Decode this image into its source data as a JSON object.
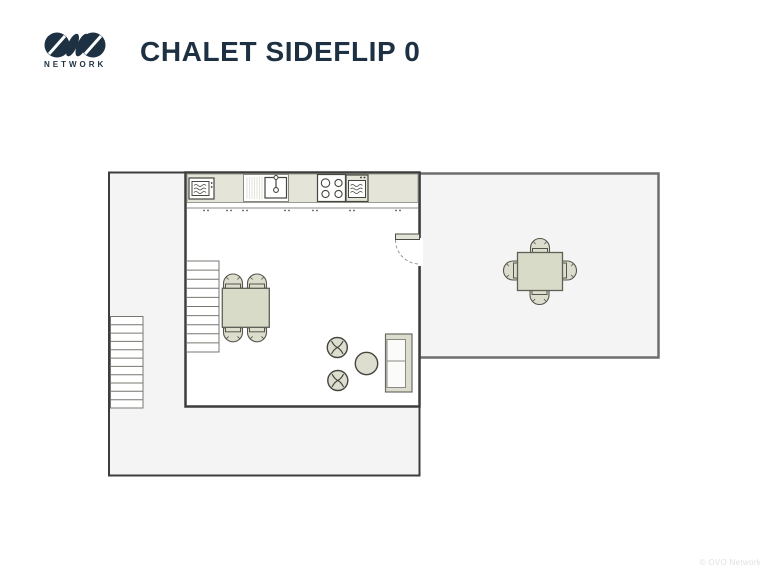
{
  "header": {
    "logo": {
      "brand": "OVO",
      "network_label": "NETWORK"
    },
    "title": "CHALET SIDEFLIP 0"
  },
  "plan": {
    "floor": "0",
    "rooms": [
      {
        "id": "living-kitchen",
        "type": "open-plan kitchen / living room"
      },
      {
        "id": "terrace-left",
        "type": "wrap-around terrace"
      },
      {
        "id": "terrace-right",
        "type": "terrace / dining deck"
      }
    ],
    "furniture_icons": [
      "microwave-icon",
      "kitchen-sink-icon",
      "hob-icon",
      "oven-icon",
      "dining-table",
      "dining-chair",
      "staircase",
      "staircase",
      "stool",
      "stool",
      "round-side-table",
      "sofa",
      "door-swing",
      "terrace-table",
      "terrace-chair"
    ]
  },
  "footer": {
    "copyright": "© OVO Network"
  },
  "colors": {
    "brand_navy": "#1d3143",
    "wall_dark": "#3d3d3d",
    "wall_gray": "#6e6e6e",
    "room_fill": "#f4f4f4",
    "furniture_fill": "#dcddcc",
    "table_fill": "#d9dbc9",
    "counter_fill": "#e4e5d8",
    "copyright_gray": "#e2e2e2"
  }
}
